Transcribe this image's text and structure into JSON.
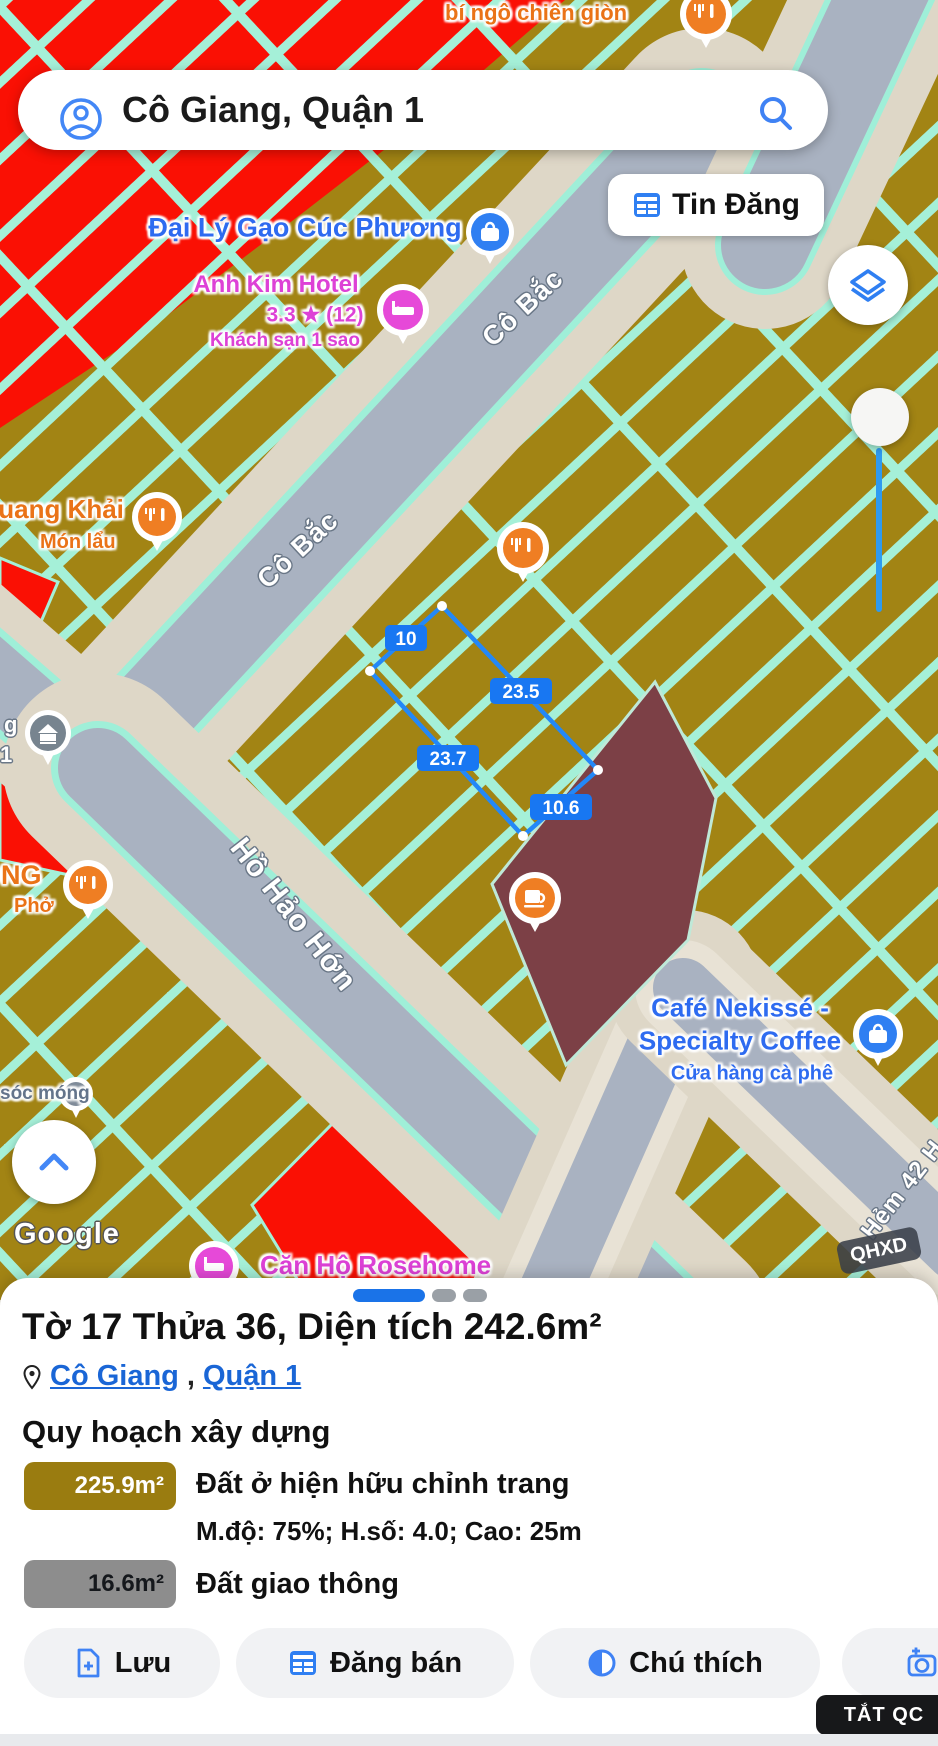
{
  "search": {
    "query": "Cô Giang, Quận 1"
  },
  "actions": {
    "tin_dang": "Tin Đăng"
  },
  "map": {
    "streets": {
      "co_bac_1": "Cô Bắc",
      "co_bac_2": "Cô Bắc",
      "ho_hao_hon": "Hồ Hảo Hớn",
      "hem_42": "Hẻm 42 H",
      "fragment_g": "g",
      "fragment_1": "1"
    },
    "pois": {
      "bi_ngo": "bí ngô chiên giòn",
      "dai_ly": "Đại Lý Gạo Cúc Phương",
      "anh_kim": {
        "name": "Anh Kim Hotel",
        "rating": "3.3 ★ (12)",
        "type": "Khách sạn 1 sao"
      },
      "quang_khai": {
        "name": "Quang Khải",
        "type": "Món lẩu"
      },
      "ong": {
        "name": "ỒNG",
        "type": "Phở"
      },
      "soc_mong": "sóc móng",
      "cafe_nekisse": {
        "line1": "Café Nekissé -",
        "line2": "Specialty Coffee",
        "type": "Cửa hàng cà phê"
      },
      "rosehome": "Căn Hộ Rosehome"
    },
    "measurements": {
      "m10": "10",
      "m235": "23.5",
      "m237": "23.7",
      "m106": "10.6"
    },
    "watermark": "Google",
    "qhxd": "QHXD"
  },
  "panel": {
    "title": "Tờ 17 Thửa 36, Diện tích 242.6m²",
    "ward": "Cô Giang",
    "comma": ", ",
    "district": "Quận 1",
    "section": "Quy hoạch xây dựng",
    "legend": [
      {
        "area": "225.9m²",
        "label": "Đất ở hiện hữu chỉnh trang",
        "detail": "M.độ: 75%; H.số: 4.0; Cao: 25m",
        "color": "#9a7c10"
      },
      {
        "area": "16.6m²",
        "label": "Đất giao thông",
        "detail": "",
        "color": "#8d8d8d"
      }
    ],
    "buttons": {
      "save": "Lưu",
      "sell": "Đăng bán",
      "legend_btn": "Chú thích"
    },
    "ad_close": "TẮT QC"
  },
  "colors": {
    "accent": "#1a73e8",
    "measure_badge": "#1877f2",
    "olive": "#a28414",
    "red": "#fa1004",
    "maroon": "#7c4046",
    "road": "#a9b2c1",
    "mint": "#a5f0d8",
    "beige": "#ded7c7"
  }
}
